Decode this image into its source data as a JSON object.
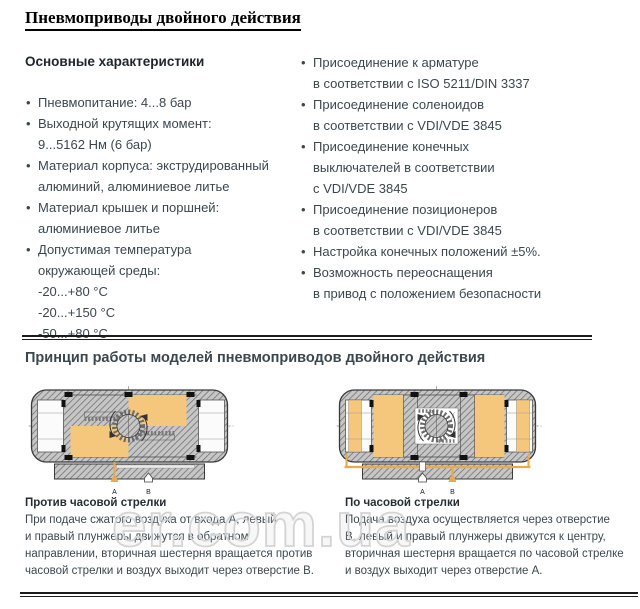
{
  "page": {
    "title": "Пневмоприводы двойного действия",
    "watermark": "er.com.ua"
  },
  "colors": {
    "chamber_orange": "#f4c77c",
    "arrow_orange": "#e9a94f",
    "text_dark_slate": "#3c474d",
    "rule_black": "#1c1c1c"
  },
  "characteristics": {
    "heading": "Основные характеристики",
    "left_items": [
      {
        "lines": [
          "Пневмопитание: 4...8 бар"
        ]
      },
      {
        "lines": [
          "Выходной крутящих момент:",
          "9...5162 Нм (6 бар)"
        ]
      },
      {
        "lines": [
          "Материал корпуса: экструдированный",
          "алюминий, алюминиевое литье"
        ]
      },
      {
        "lines": [
          "Материал крышек и поршней:",
          "алюминиевое литье"
        ]
      },
      {
        "lines": [
          "Допустимая температура",
          "окружающей среды:",
          "-20...+80 °C",
          "-20...+150 °C",
          "-50...+80 °C"
        ]
      }
    ],
    "right_items": [
      {
        "lines": [
          "Присоединение к арматуре",
          "в соответствии с ISO 5211/DIN 3337"
        ]
      },
      {
        "lines": [
          "Присоединение соленоидов",
          "в соответствии с VDI/VDE 3845"
        ]
      },
      {
        "lines": [
          "Присоединение конечных",
          "выключателей в соответствии",
          "с VDI/VDE 3845"
        ]
      },
      {
        "lines": [
          "Присоединение позиционеров",
          "в соответствии с VDI/VDE 3845"
        ]
      },
      {
        "lines": [
          "Настройка конечных положений ±5%."
        ]
      },
      {
        "lines": [
          "Возможность переоснащения",
          "в привод с положением безопасности"
        ]
      }
    ]
  },
  "principle": {
    "heading": "Принцип работы моделей пневмоприводов двойного действия",
    "diagrams": [
      {
        "rotation": "counterclockwise",
        "port_a": "A",
        "port_b": "B",
        "caption_title": "Против часовой стрелки",
        "caption_lines": [
          "При подаче сжатого воздуха от входа А, левый",
          "и правый плунжеры движутся в обратном",
          "направлении, вторичная шестерня вращается против",
          "часовой стрелки и воздух выходит через отверстие В."
        ]
      },
      {
        "rotation": "clockwise",
        "port_a": "A",
        "port_b": "B",
        "caption_title": "По часовой стрелки",
        "caption_lines": [
          "Подача воздуха осуществляется через отверстие",
          "В, левый и правый плунжеры движутся к центру,",
          "вторичная шестерня вращается по часовой стрелке",
          "и воздух выходит через отверстие А."
        ]
      }
    ]
  }
}
